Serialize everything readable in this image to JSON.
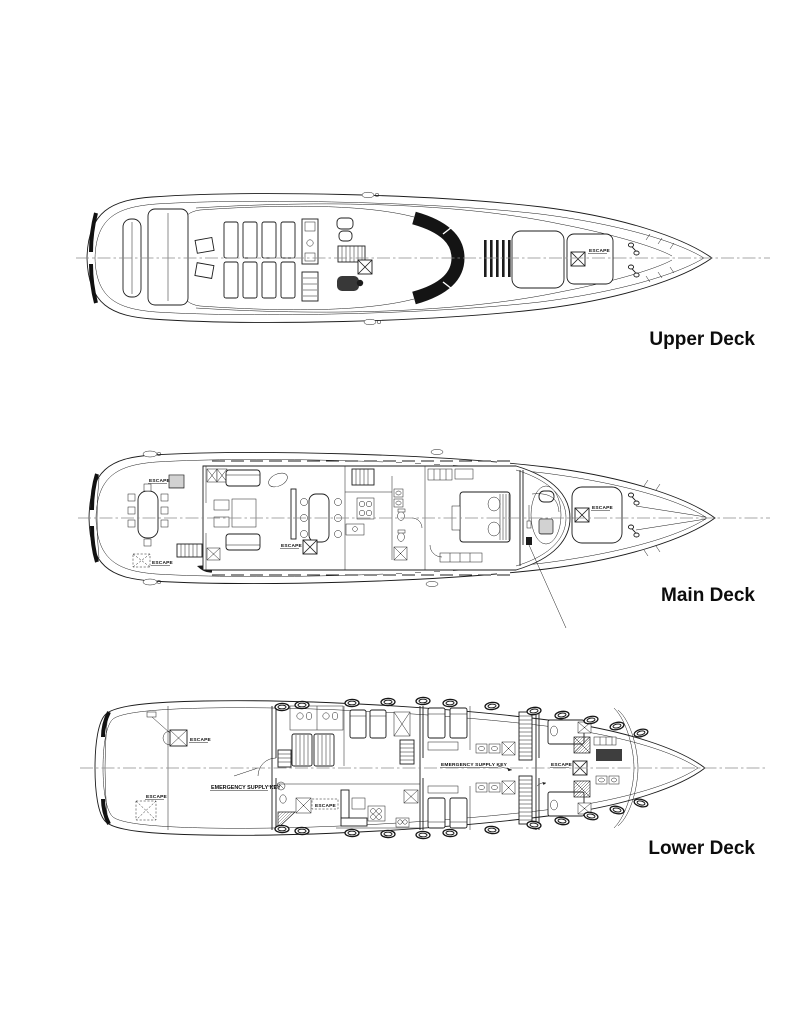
{
  "document": {
    "type": "yacht-deck-plan",
    "description": "Top-view general arrangement drawing of a motor yacht on three decks"
  },
  "annotations": {
    "escape": "ESCAPE",
    "emergency_supply_key": "EMERGENCY SUPPLY KEY"
  },
  "decks": [
    {
      "id": "upper-deck",
      "label": "Upper Deck",
      "escape_label_count": 1,
      "features": [
        "aft-sun-pad",
        "deck-loungers",
        "wet-bar",
        "grill-unit",
        "stairway",
        "windshield",
        "vent-grille",
        "foredeck-panels",
        "escape-hatch",
        "mooring-cleats"
      ]
    },
    {
      "id": "main-deck",
      "label": "Main Deck",
      "escape_label_count": 4,
      "features": [
        "aft-dining-table",
        "salon-sofas",
        "dining-table",
        "galley",
        "guest-head",
        "master-cabin-bed",
        "wheelhouse-helm",
        "foredeck-sun-pad",
        "escape-hatches",
        "window-band"
      ]
    },
    {
      "id": "lower-deck",
      "label": "Lower Deck",
      "escape_label_count": 4,
      "emergency_supply_key_label_count": 2,
      "features": [
        "engine-room",
        "escape-hatches",
        "crew-quarters",
        "crew-mess",
        "guest-cabins",
        "twin-beds",
        "heads-with-showers",
        "stairways",
        "forward-crew-cabin",
        "portholes"
      ]
    }
  ],
  "colors": {
    "background": "#ffffff",
    "linework": "#1c1c1c",
    "centerline": "#8a8a8a",
    "label_text": "#0c0c0c"
  }
}
